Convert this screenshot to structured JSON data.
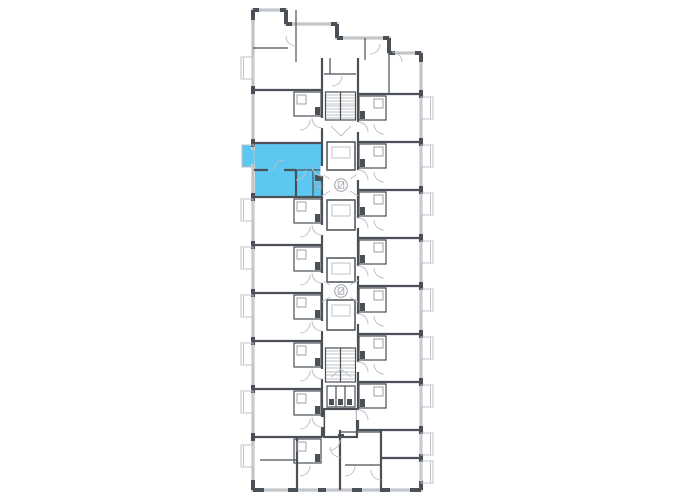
{
  "floor_plan": {
    "description": "Residential building floor plan with one apartment highlighted",
    "colors": {
      "background": "#FFFFFF",
      "wall": "#4A5056",
      "line_mid": "#9BA1A7",
      "line_light": "#BCC1C6",
      "glazing": "#D9DCDE",
      "highlight": "#5CC8F1"
    },
    "selected_apartment": {
      "name": "selected-apartment",
      "selected": true,
      "rooms": "one-bedroom with balcony",
      "position": "left column, second tier from top"
    },
    "icons": [
      {
        "name": "elevator-icon",
        "shape": "circle-with-lift-glyph"
      },
      {
        "name": "elevator-icon",
        "shape": "circle-with-lift-glyph"
      },
      {
        "name": "staircase-icon",
        "shape": "tread-lines"
      },
      {
        "name": "staircase-icon",
        "shape": "tread-lines"
      }
    ]
  }
}
